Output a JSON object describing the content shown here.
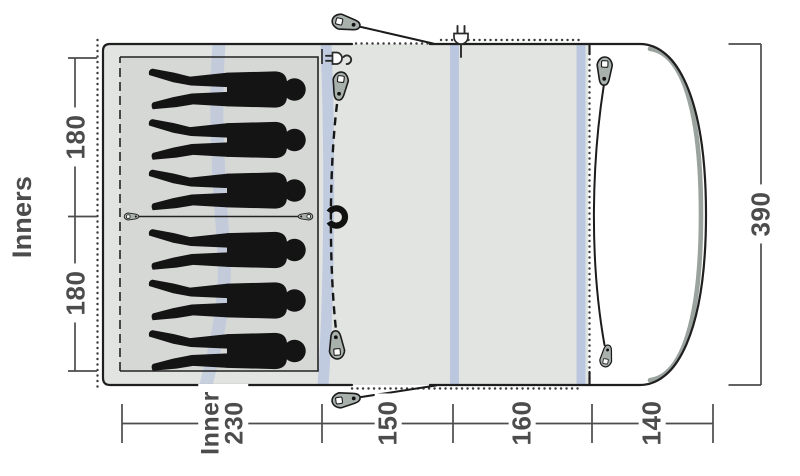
{
  "diagram": {
    "name": "Tent floorplan top view",
    "sleeping_positions": 6,
    "dimensions": {
      "side_label": "Inners",
      "inner_cabin_1": "180",
      "inner_cabin_2": "180",
      "inner_width_word": "Inner",
      "inner_width_value": "230",
      "mid_section": "150",
      "living_section": "160",
      "front_section": "140",
      "depth": "390"
    },
    "icons": {
      "tent_peg": "teardrop-peg-shape",
      "guyline_toggle": "small-toggle-shape",
      "magnet_closure": "c-magnet-shape",
      "power_inlet": "plug-glyph",
      "zipper_pull": "zip-slider-shape",
      "sleeper": "person-silhouette"
    },
    "colors": {
      "floor": "#e2e4e2",
      "inner_mat": "#d6d8d6",
      "pole_band": "#b6c3de",
      "pole_gray": "#9ba39f",
      "peg_fill": "#a9b1ad",
      "outline": "#222222",
      "dim_text": "#4c4c4c"
    }
  }
}
